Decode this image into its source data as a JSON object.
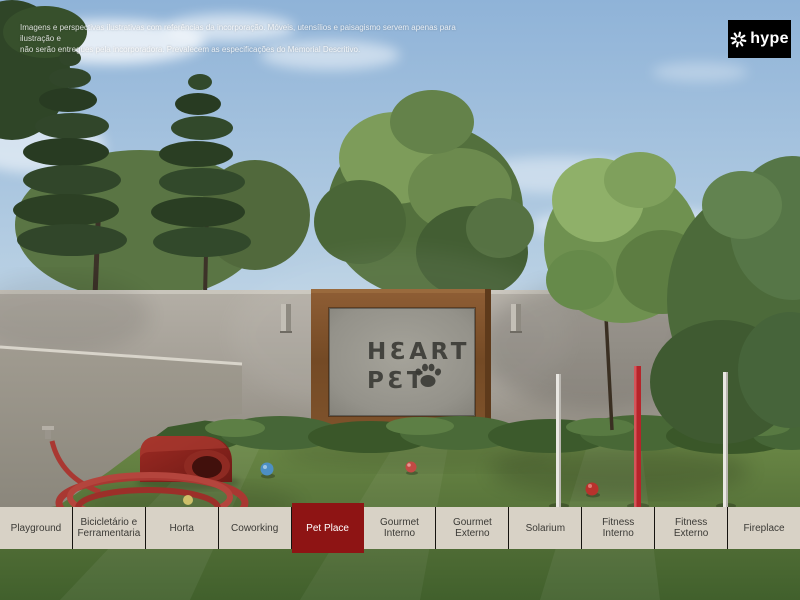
{
  "disclaimer": {
    "line1": "Imagens e perspectivas ilustrativas com referências da incorporação. Móveis, utensílios e paisagismo servem apenas para ilustração e",
    "line2": "não serão entregues pela incorporadora. Prevalecem as especificações do Memorial Descritivo."
  },
  "logo": {
    "text": "hype",
    "icon": "pinwheel-asterisk-icon"
  },
  "scene": {
    "sign": {
      "line1": "HƐART",
      "line2": "PƐT",
      "icon": "paw-icon"
    }
  },
  "tabbar": {
    "active_label": "Pet Place",
    "items": [
      {
        "label": "Playground",
        "active": false
      },
      {
        "label": "Bicicletário e Ferramentaria",
        "active": false
      },
      {
        "label": "Horta",
        "active": false
      },
      {
        "label": "Coworking",
        "active": false
      },
      {
        "label": "Pet Place",
        "active": true
      },
      {
        "label": "Gourmet Interno",
        "active": false
      },
      {
        "label": "Gourmet Externo",
        "active": false
      },
      {
        "label": "Solarium",
        "active": false
      },
      {
        "label": "Fitness Interno",
        "active": false
      },
      {
        "label": "Fitness Externo",
        "active": false
      },
      {
        "label": "Fireplace",
        "active": false
      }
    ]
  },
  "colors": {
    "accent_red": "#8e1414",
    "tab_bg": "#d8d2c6",
    "tab_text": "#3b3a36",
    "active_tab_text": "#ffffff",
    "logo_bg": "#000000",
    "logo_text": "#ffffff",
    "sign_text": "#3a3a35",
    "wood_frame": "#7a4e2b"
  }
}
